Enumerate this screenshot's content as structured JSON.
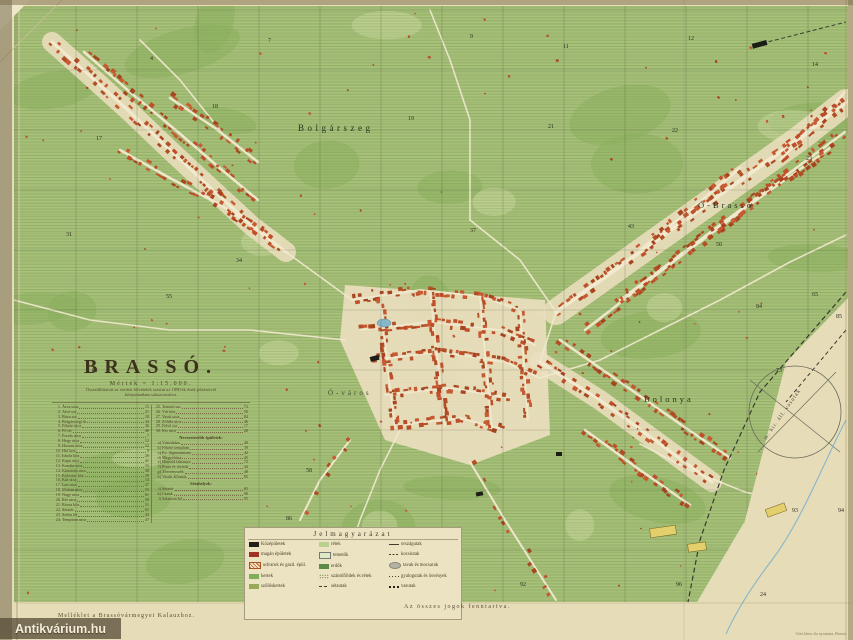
{
  "colors": {
    "paper": "#e6dcb8",
    "terrain_green": "#a9c27b",
    "building_red": "#bf4f2a",
    "water_blue": "#86b7c9",
    "grid": "#3d4632"
  },
  "watermark": {
    "text": "Antikvárium.hu"
  },
  "title_block": {
    "title": "BRASSÓ.",
    "scale": "Mérték = 1:15.000.",
    "subtitle1": "Összeállíttatott az eredeti fölvételek szerint az 1890-ik évek jelzéseivel",
    "subtitle2": "kőnyomatban sokszorosítva."
  },
  "captions": {
    "rights": "Az összes jogok fenntartva.",
    "supplement": "Melléklet a Brassóvármegyei Kalauzhoz.",
    "printer": "Gött János fia nyomása, Brassó."
  },
  "legend": {
    "title": "Jelmagyarázat",
    "columns": [
      [
        {
          "swatch": "black",
          "label": "Középületek"
        },
        {
          "swatch": "red",
          "label": "magán épületek"
        },
        {
          "swatch": "hatch",
          "label": "udvarok és gazd. épül."
        },
        {
          "swatch": "green",
          "label": "kertek"
        },
        {
          "swatch": "olive",
          "label": "szőlőskertek"
        }
      ],
      [
        {
          "swatch": "lightgreen",
          "label": "rétek"
        },
        {
          "swatch": "cross",
          "label": "temetők"
        },
        {
          "swatch": "darkgreen",
          "label": "erdők"
        },
        {
          "swatch": "dots",
          "label": "szántóföldek és rétek"
        },
        {
          "swatch": "dash",
          "label": "sétautak"
        }
      ],
      [
        {
          "swatch": "road",
          "label": "országutak"
        },
        {
          "swatch": "dash2",
          "label": "kocsiutak"
        },
        {
          "swatch": "oval",
          "label": "tavak és mocsarak"
        },
        {
          "swatch": "dash3",
          "label": "gyalogutak és ösvények"
        },
        {
          "swatch": "rail",
          "label": "vasutak"
        }
      ]
    ]
  },
  "map": {
    "labels": [
      {
        "text": "Bolgárszeg",
        "x": 298,
        "y": 131
      },
      {
        "text": "Ó-Brassó",
        "x": 698,
        "y": 208
      },
      {
        "text": "Bolonya",
        "x": 644,
        "y": 402
      },
      {
        "text": "Ó-város",
        "x": 328,
        "y": 395
      }
    ],
    "rail_label": "m. kir. áll. vasutak",
    "grid_numbers": [
      {
        "t": "4",
        "x": 150,
        "y": 60
      },
      {
        "t": "7",
        "x": 268,
        "y": 42
      },
      {
        "t": "9",
        "x": 470,
        "y": 38
      },
      {
        "t": "11",
        "x": 563,
        "y": 48
      },
      {
        "t": "12",
        "x": 688,
        "y": 40
      },
      {
        "t": "14",
        "x": 812,
        "y": 66
      },
      {
        "t": "17",
        "x": 96,
        "y": 140
      },
      {
        "t": "18",
        "x": 212,
        "y": 108
      },
      {
        "t": "19",
        "x": 408,
        "y": 120
      },
      {
        "t": "21",
        "x": 548,
        "y": 128
      },
      {
        "t": "22",
        "x": 672,
        "y": 132
      },
      {
        "t": "23",
        "x": 806,
        "y": 160
      },
      {
        "t": "31",
        "x": 66,
        "y": 236
      },
      {
        "t": "34",
        "x": 236,
        "y": 262
      },
      {
        "t": "37",
        "x": 470,
        "y": 232
      },
      {
        "t": "43",
        "x": 628,
        "y": 228
      },
      {
        "t": "50",
        "x": 716,
        "y": 246
      },
      {
        "t": "55",
        "x": 166,
        "y": 298
      },
      {
        "t": "58",
        "x": 306,
        "y": 472
      },
      {
        "t": "61",
        "x": 92,
        "y": 372
      },
      {
        "t": "65",
        "x": 812,
        "y": 296
      },
      {
        "t": "73",
        "x": 776,
        "y": 372
      },
      {
        "t": "84",
        "x": 756,
        "y": 308
      },
      {
        "t": "85",
        "x": 836,
        "y": 318
      },
      {
        "t": "86",
        "x": 286,
        "y": 520
      },
      {
        "t": "92",
        "x": 520,
        "y": 586
      },
      {
        "t": "93",
        "x": 792,
        "y": 512
      },
      {
        "t": "94",
        "x": 838,
        "y": 512
      },
      {
        "t": "24",
        "x": 760,
        "y": 596
      },
      {
        "t": "96",
        "x": 676,
        "y": 586
      }
    ]
  },
  "index": {
    "left": [
      {
        "n": "1.",
        "name": "Árva utca",
        "p": "15"
      },
      {
        "n": "2.",
        "name": "Alsó sor",
        "p": "21"
      },
      {
        "n": "3.",
        "name": "Búza sor",
        "p": "18"
      },
      {
        "n": "4.",
        "name": "Bolgárszegi út",
        "p": "44"
      },
      {
        "n": "5.",
        "name": "Fekete utca",
        "p": "36"
      },
      {
        "n": "6.",
        "name": "Fő tér",
        "p": "40"
      },
      {
        "n": "7.",
        "name": "Forrás utca",
        "p": "7"
      },
      {
        "n": "8.",
        "name": "Hegy utca",
        "p": "12"
      },
      {
        "n": "9.",
        "name": "Hosszú utca",
        "p": "52"
      },
      {
        "n": "10.",
        "name": "Híd köz",
        "p": "9"
      },
      {
        "n": "11.",
        "name": "Iskola köz",
        "p": "26"
      },
      {
        "n": "12.",
        "name": "Kapu utca",
        "p": "41"
      },
      {
        "n": "13.",
        "name": "Katalin utca",
        "p": "33"
      },
      {
        "n": "14.",
        "name": "Klastrom utca",
        "p": "38"
      },
      {
        "n": "15.",
        "name": "Kolostor köz",
        "p": "29"
      },
      {
        "n": "16.",
        "name": "Kút utca",
        "p": "14"
      },
      {
        "n": "17.",
        "name": "Len utca",
        "p": "47"
      },
      {
        "n": "18.",
        "name": "Malom utca",
        "p": "55"
      },
      {
        "n": "19.",
        "name": "Nagy utca",
        "p": "61"
      },
      {
        "n": "20.",
        "name": "Rét utca",
        "p": "58"
      },
      {
        "n": "21.",
        "name": "Rózsa köz",
        "p": "31"
      },
      {
        "n": "22.",
        "name": "Sétatér",
        "p": "65"
      },
      {
        "n": "23.",
        "name": "Széna tér",
        "p": "43"
      },
      {
        "n": "24.",
        "name": "Templom utca",
        "p": "37"
      }
    ],
    "right": [
      {
        "n": "25.",
        "name": "Temető sor",
        "p": "73"
      },
      {
        "n": "26.",
        "name": "Vár köz",
        "p": "50"
      },
      {
        "n": "27.",
        "name": "Vasút utca",
        "p": "84"
      },
      {
        "n": "28.",
        "name": "Zöldfa utca",
        "p": "46"
      },
      {
        "n": "29.",
        "name": "Felső sor",
        "p": "17"
      },
      {
        "n": "30.",
        "name": "Kis utca",
        "p": "28"
      },
      {
        "h": "Nevezetesebb épületek:"
      },
      {
        "n": "a)",
        "name": "Városháza",
        "p": "40"
      },
      {
        "n": "b)",
        "name": "Fekete templom",
        "p": "39"
      },
      {
        "n": "c)",
        "name": "Ev. főgimnázium",
        "p": "42"
      },
      {
        "n": "d)",
        "name": "Megyeháza",
        "p": "45"
      },
      {
        "n": "e)",
        "name": "Honvéd laktanya",
        "p": "72"
      },
      {
        "n": "f)",
        "name": "Posta és távírda",
        "p": "44"
      },
      {
        "n": "g)",
        "name": "Törvényszék",
        "p": "48"
      },
      {
        "n": "h)",
        "name": "Vasúti állomás",
        "p": "85"
      },
      {
        "h": "Sétahelyek:"
      },
      {
        "n": "i)",
        "name": "Sétatér",
        "p": "65"
      },
      {
        "n": "k)",
        "name": "Czenk",
        "p": "90"
      },
      {
        "n": "l)",
        "name": "Salamon-kő",
        "p": "95"
      }
    ]
  }
}
